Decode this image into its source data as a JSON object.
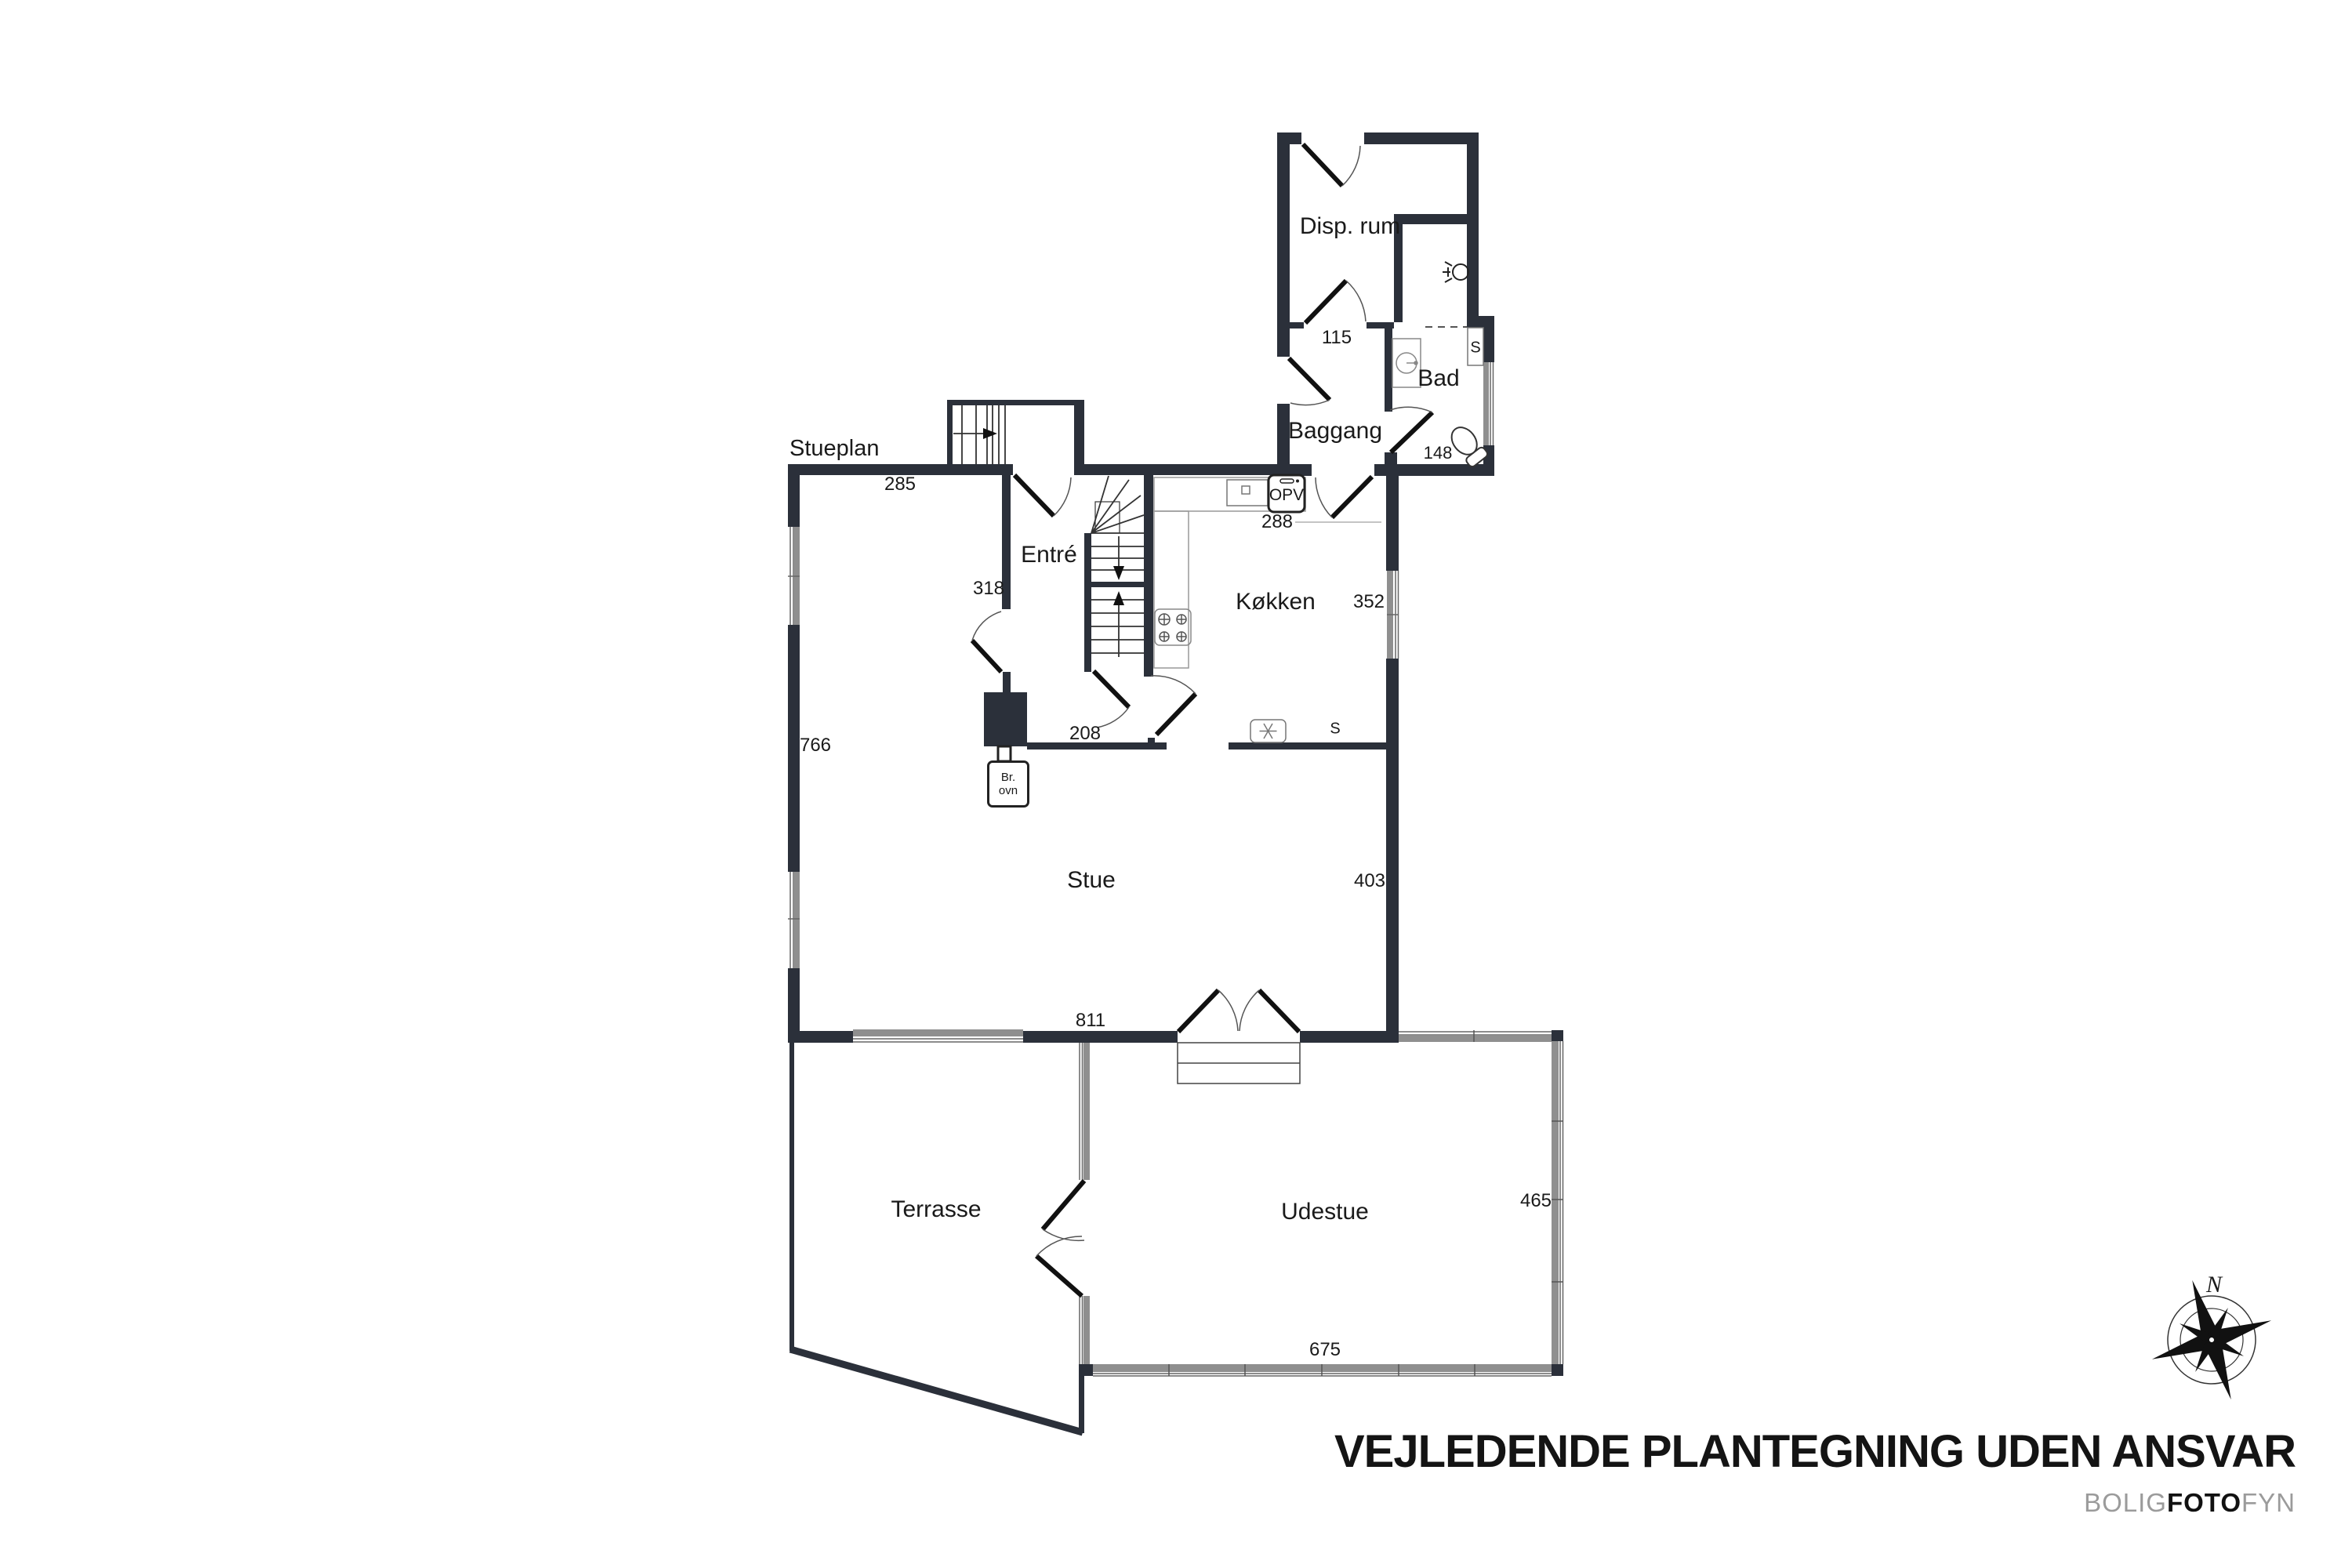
{
  "plan": {
    "title": "Stueplan",
    "rooms": [
      {
        "label": "Disp. rum"
      },
      {
        "label": "Baggang"
      },
      {
        "label": "Bad"
      },
      {
        "label": "Entré"
      },
      {
        "label": "Køkken"
      },
      {
        "label": "Stue"
      },
      {
        "label": "Terrasse"
      },
      {
        "label": "Udestue"
      }
    ],
    "measurements": [
      "115",
      "148",
      "285",
      "288",
      "318",
      "352",
      "208",
      "766",
      "403",
      "811",
      "465",
      "675"
    ],
    "fixtures": [
      "OPV",
      "Br. ovn",
      "S (kitchen)",
      "S (bath)",
      "stove",
      "fridge",
      "sink",
      "toilet",
      "stairs"
    ]
  },
  "labels": {
    "stueplan": "Stueplan",
    "disp_rum": "Disp. rum",
    "baggang": "Baggang",
    "bad": "Bad",
    "entre": "Entré",
    "kokken": "Køkken",
    "stue": "Stue",
    "terrasse": "Terrasse",
    "udestue": "Udestue",
    "opv": "OPV",
    "br_ovn_line1": "Br.",
    "br_ovn_line2": "ovn",
    "s_kitchen": "S",
    "s_bad": "S",
    "m115": "115",
    "m148": "148",
    "m285": "285",
    "m288": "288",
    "m318": "318",
    "m352": "352",
    "m208": "208",
    "m766": "766",
    "m403": "403",
    "m811": "811",
    "m465": "465",
    "m675": "675",
    "north": "N"
  },
  "footer": {
    "disclaimer": "VEJLEDENDE PLANTEGNING UDEN ANSVAR",
    "brand_part1": "BOLIG",
    "brand_part2": "FOTO",
    "brand_part3": "FYN"
  },
  "colors": {
    "wall": "#2b303a",
    "window_glass": "#8f8f8f",
    "door_leaf": "#111111",
    "arc": "#555555",
    "brand_gray": "#9b9b9b",
    "text": "#1a1a1a"
  }
}
